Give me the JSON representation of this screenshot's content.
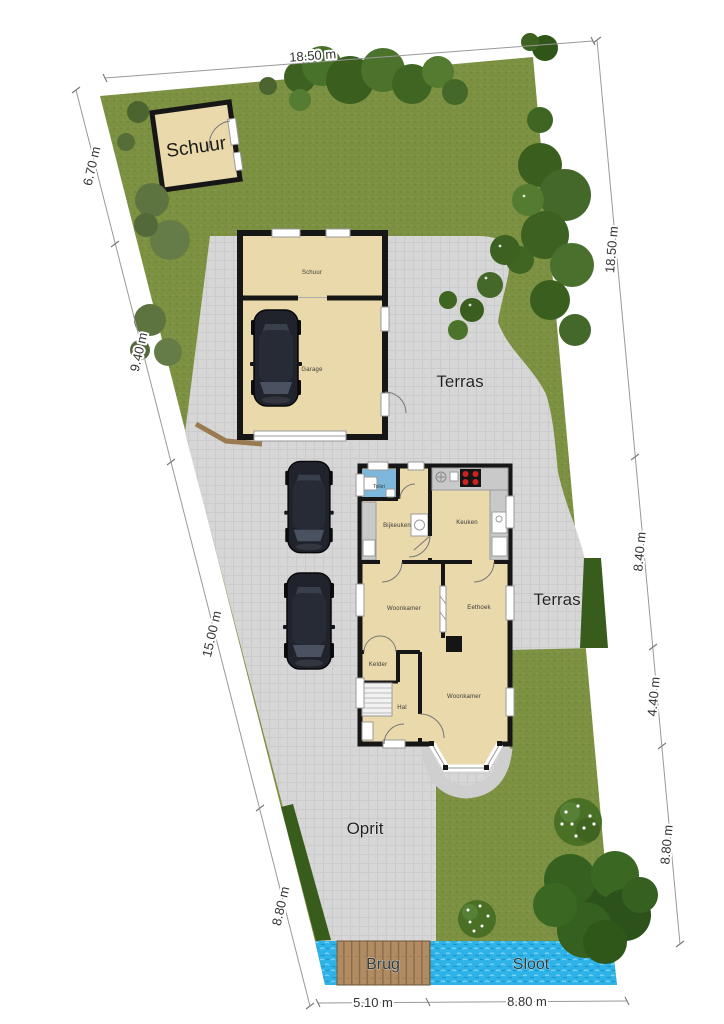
{
  "plan": {
    "type": "residential site plan with floorplan",
    "outdoor_labels": {
      "schuur": "Schuur",
      "terras_upper": "Terras",
      "terras_lower": "Terras",
      "oprit": "Oprit",
      "brug": "Brug",
      "sloot": "Sloot"
    },
    "room_labels": {
      "schuur": "Schuur",
      "garage": "Garage",
      "toilet": "Toilet",
      "bijkeuken": "Bijkeuken",
      "keuken": "Keuken",
      "woonkamer_mid": "Woonkamer",
      "eethoek": "Eethoek",
      "kelder": "Kelder",
      "hal": "Hal",
      "woonkamer_front": "Woonkamer"
    },
    "dimensions": {
      "top": [
        "18.50 m"
      ],
      "left": [
        "6.70 m",
        "9.40 m",
        "15.00 m",
        "8.80 m"
      ],
      "right": [
        "18.50 m",
        "8.40 m",
        "4.40 m",
        "8.80 m"
      ],
      "bottom": [
        "5.10 m",
        "8.80 m"
      ]
    },
    "colors": {
      "grass": "#7d9143",
      "paving": "#d6d6d6",
      "building_fill": "#e9d9ab",
      "wall": "#161616",
      "water": "#2eb3e8",
      "bridge_wood": "#b18c63",
      "hedge": "#375c1c",
      "toilet_floor": "#7db8dc"
    }
  }
}
